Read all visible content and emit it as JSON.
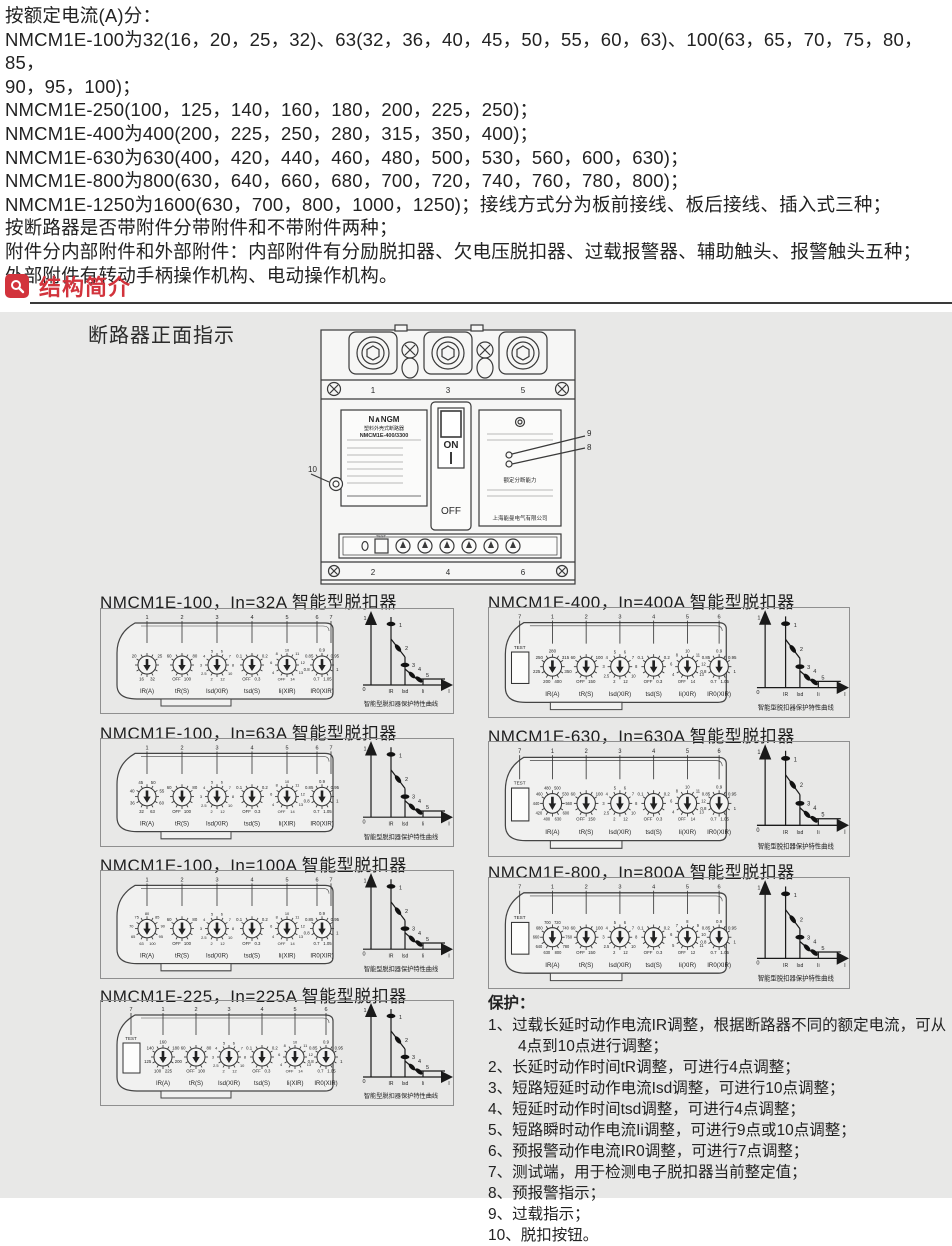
{
  "intro": {
    "lines": [
      "按额定电流(A)分：",
      "NMCM1E-100为32(16，20，25，32)、63(32，36，40，45，50，55，60，63)、100(63，65，70，75，80，85，",
      "90，95，100)；",
      "NMCM1E-250(100，125，140，160，180，200，225，250)；",
      "NMCM1E-400为400(200，225，250，280，315，350，400)；",
      "NMCM1E-630为630(400，420，440，460，480，500，530，560，600，630)；",
      "NMCM1E-800为800(630，640，660，680，700，720，740，760，780，800)；",
      "NMCM1E-1250为1600(630，700，800，1000，1250)；接线方式分为板前接线、板后接线、插入式三种；",
      "按断路器是否带附件分带附件和不带附件两种；",
      "附件分内部附件和外部附件：内部附件有分励脱扣器、欠电压脱扣器、过载报警器、辅助触头、报警触头五种；",
      "外部附件有转动手柄操作机构、电动操作机构。"
    ]
  },
  "section_header": {
    "label": "结构简介",
    "icon": "magnifier-icon",
    "accent_color": "#d2333c"
  },
  "structure_panel": {
    "front_view_label": "断路器正面指示",
    "breaker": {
      "brand": "N∧NGM",
      "product_type": "塑料外壳式断路器",
      "model": "NMCM1E-400/3300",
      "on_label": "ON",
      "off_label": "OFF",
      "test_label": "TEST",
      "breaking_capacity_label": "额定分断能力",
      "company": "上海能曼电气有限公司",
      "top_pole_numbers": [
        "1",
        "3",
        "5"
      ],
      "bottom_pole_numbers": [
        "2",
        "4",
        "6"
      ],
      "callout_left": "10",
      "callout_upper_right": "9",
      "callout_lower_right": "8"
    },
    "curve": {
      "y_max_label": "1",
      "origin_label": "0",
      "x_axis_label": "I",
      "x_tick_labels": [
        "IR",
        "Isd",
        "Ii"
      ],
      "point_labels": [
        "1",
        "2",
        "3",
        "4",
        "5"
      ],
      "caption": "智能型脱扣器保护特性曲线"
    },
    "sections": [
      {
        "title": "NMCM1E-100，In=32A 智能型脱扣器",
        "has_test_button": false,
        "dials": [
          {
            "label": "IR(A)",
            "values": [
              "16",
              "20",
              "25",
              "32"
            ]
          },
          {
            "label": "tR(S)",
            "values": [
              "OFF",
              "60",
              "80",
              "100"
            ]
          },
          {
            "label": "Isd(XIR)",
            "values": [
              "2",
              "2.5",
              "3",
              "4",
              "5",
              "6",
              "7",
              "8",
              "10",
              "12"
            ]
          },
          {
            "label": "tsd(S)",
            "values": [
              "OFF",
              "0.1",
              "0.2",
              "0.3"
            ]
          },
          {
            "label": "Ii(XIR)",
            "values": [
              "OFF",
              "4",
              "6",
              "8",
              "10",
              "11",
              "12",
              "13",
              "14"
            ]
          },
          {
            "label": "IR0(XIR)",
            "values": [
              "0.7",
              "0.8",
              "0.85",
              "0.9",
              "0.95",
              "1",
              "1.05"
            ]
          }
        ]
      },
      {
        "title": "NMCM1E-100，In=63A 智能型脱扣器",
        "has_test_button": false,
        "dials": [
          {
            "label": "IR(A)",
            "values": [
              "32",
              "36",
              "40",
              "45",
              "50",
              "55",
              "60",
              "63"
            ]
          },
          {
            "label": "tR(S)",
            "values": [
              "OFF",
              "60",
              "80",
              "100"
            ]
          },
          {
            "label": "Isd(XIR)",
            "values": [
              "2",
              "2.5",
              "3",
              "4",
              "5",
              "6",
              "7",
              "8",
              "10",
              "12"
            ]
          },
          {
            "label": "tsd(S)",
            "values": [
              "OFF",
              "0.1",
              "0.2",
              "0.3"
            ]
          },
          {
            "label": "Ii(XIR)",
            "values": [
              "OFF",
              "4",
              "6",
              "8",
              "10",
              "11",
              "12",
              "13",
              "14"
            ]
          },
          {
            "label": "IR0(XIR)",
            "values": [
              "0.7",
              "0.8",
              "0.85",
              "0.9",
              "0.95",
              "1",
              "1.05"
            ]
          }
        ]
      },
      {
        "title": "NMCM1E-100，In=100A 智能型脱扣器",
        "has_test_button": false,
        "dials": [
          {
            "label": "IR(A)",
            "values": [
              "63",
              "65",
              "70",
              "75",
              "80",
              "85",
              "90",
              "95",
              "100"
            ]
          },
          {
            "label": "tR(S)",
            "values": [
              "OFF",
              "60",
              "80",
              "100"
            ]
          },
          {
            "label": "Isd(XIR)",
            "values": [
              "2",
              "2.5",
              "3",
              "4",
              "5",
              "6",
              "7",
              "8",
              "10",
              "12"
            ]
          },
          {
            "label": "tsd(S)",
            "values": [
              "OFF",
              "0.1",
              "0.2",
              "0.3"
            ]
          },
          {
            "label": "Ii(XIR)",
            "values": [
              "OFF",
              "4",
              "6",
              "8",
              "10",
              "11",
              "12",
              "13",
              "14"
            ]
          },
          {
            "label": "IR0(XIR)",
            "values": [
              "0.7",
              "0.8",
              "0.85",
              "0.9",
              "0.95",
              "1",
              "1.05"
            ]
          }
        ]
      },
      {
        "title": "NMCM1E-225，In=225A 智能型脱扣器",
        "has_test_button": true,
        "dials": [
          {
            "label": "IR(A)",
            "values": [
              "100",
              "125",
              "140",
              "160",
              "180",
              "200",
              "225"
            ]
          },
          {
            "label": "tR(S)",
            "values": [
              "OFF",
              "60",
              "80",
              "100"
            ]
          },
          {
            "label": "Isd(XIR)",
            "values": [
              "2",
              "2.5",
              "3",
              "4",
              "5",
              "6",
              "7",
              "8",
              "10",
              "12"
            ]
          },
          {
            "label": "tsd(S)",
            "values": [
              "OFF",
              "0.1",
              "0.2",
              "0.3"
            ]
          },
          {
            "label": "Ii(XIR)",
            "values": [
              "OFF",
              "4",
              "6",
              "8",
              "10",
              "11",
              "12",
              "13",
              "14"
            ]
          },
          {
            "label": "IR0(XIR)",
            "values": [
              "0.7",
              "0.8",
              "0.85",
              "0.9",
              "0.95",
              "1",
              "1.05"
            ]
          }
        ]
      },
      {
        "title": "NMCM1E-400，In=400A 智能型脱扣器",
        "has_test_button": true,
        "dials": [
          {
            "label": "IR(A)",
            "values": [
              "200",
              "225",
              "250",
              "280",
              "315",
              "350",
              "400"
            ]
          },
          {
            "label": "tR(S)",
            "values": [
              "OFF",
              "60",
              "100",
              "150"
            ]
          },
          {
            "label": "Isd(XIR)",
            "values": [
              "2",
              "2.5",
              "3",
              "4",
              "5",
              "6",
              "7",
              "8",
              "10",
              "12"
            ]
          },
          {
            "label": "tsd(S)",
            "values": [
              "OFF",
              "0.1",
              "0.2",
              "0.3"
            ]
          },
          {
            "label": "Ii(XIR)",
            "values": [
              "OFF",
              "4",
              "6",
              "8",
              "10",
              "11",
              "12",
              "13",
              "14"
            ]
          },
          {
            "label": "IR0(XIR)",
            "values": [
              "0.7",
              "0.8",
              "0.85",
              "0.9",
              "0.95",
              "1",
              "1.05"
            ]
          }
        ]
      },
      {
        "title": "NMCM1E-630，In=630A 智能型脱扣器",
        "has_test_button": true,
        "dials": [
          {
            "label": "IR(A)",
            "values": [
              "400",
              "420",
              "440",
              "460",
              "480",
              "500",
              "530",
              "560",
              "600",
              "630"
            ]
          },
          {
            "label": "tR(S)",
            "values": [
              "OFF",
              "60",
              "100",
              "150"
            ]
          },
          {
            "label": "Isd(XIR)",
            "values": [
              "2",
              "2.5",
              "3",
              "4",
              "5",
              "6",
              "7",
              "8",
              "10",
              "12"
            ]
          },
          {
            "label": "tsd(S)",
            "values": [
              "OFF",
              "0.1",
              "0.2",
              "0.3"
            ]
          },
          {
            "label": "Ii(XIR)",
            "values": [
              "OFF",
              "4",
              "6",
              "8",
              "10",
              "11",
              "12",
              "13",
              "14"
            ]
          },
          {
            "label": "IR0(XIR)",
            "values": [
              "0.7",
              "0.8",
              "0.85",
              "0.9",
              "0.95",
              "1",
              "1.05"
            ]
          }
        ]
      },
      {
        "title": "NMCM1E-800，In=800A 智能型脱扣器",
        "has_test_button": true,
        "dials": [
          {
            "label": "IR(A)",
            "values": [
              "630",
              "640",
              "660",
              "680",
              "700",
              "720",
              "740",
              "760",
              "780",
              "800"
            ]
          },
          {
            "label": "tR(S)",
            "values": [
              "OFF",
              "60",
              "100",
              "150"
            ]
          },
          {
            "label": "Isd(XIR)",
            "values": [
              "2",
              "2.5",
              "3",
              "4",
              "5",
              "6",
              "7",
              "8",
              "10",
              "12"
            ]
          },
          {
            "label": "tsd(S)",
            "values": [
              "OFF",
              "0.1",
              "0.2",
              "0.3"
            ]
          },
          {
            "label": "Ii(XIR)",
            "values": [
              "OFF",
              "5",
              "6",
              "7",
              "8",
              "9",
              "10",
              "11",
              "12"
            ]
          },
          {
            "label": "IR0(XIR)",
            "values": [
              "0.7",
              "0.8",
              "0.85",
              "0.9",
              "0.95",
              "1",
              "1.05"
            ]
          }
        ]
      }
    ],
    "protection": {
      "title": "保护：",
      "items": [
        "1、过载长延时动作电流IR调整，根据断路器不同的额定电流，可从4点到10点进行调整；",
        "2、长延时动作时间tR调整，可进行4点调整；",
        "3、短路短延时动作电流Isd调整，可进行10点调整；",
        "4、短延时动作时间tsd调整，可进行4点调整；",
        "5、短路瞬时动作电流Ii调整，可进行9点或10点调整；",
        "6、预报警动作电流IR0调整，可进行7点调整；",
        "7、测试端，用于检测电子脱扣器当前整定值；",
        "8、预报警指示；",
        "9、过载指示；",
        "10、脱扣按钮。"
      ]
    }
  }
}
